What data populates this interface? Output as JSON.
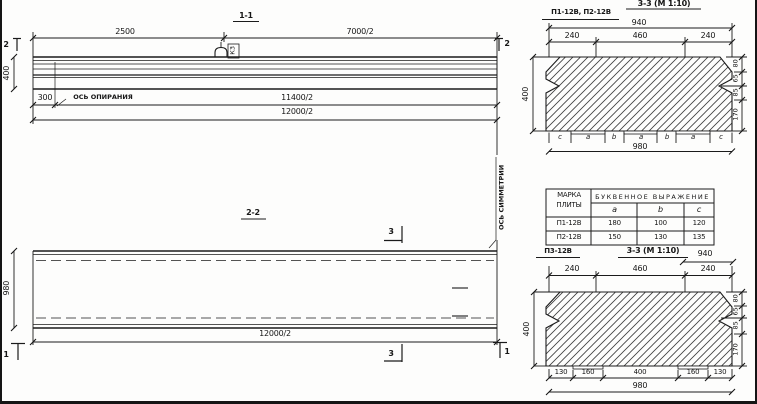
{
  "s11": {
    "title": "1-1",
    "marker2": "2",
    "dim2500": "2500",
    "dim7000": "7000/2",
    "dim400": "400",
    "dim300": "300",
    "support_axis": "ОСЬ ОПИРАНИЯ",
    "hook_mark": "К3",
    "dim11400": "11400/2",
    "dim12000": "12000/2"
  },
  "s22": {
    "title": "2-2",
    "marker3": "3",
    "marker1": "1",
    "dim980": "980",
    "dim12000": "12000/2",
    "symmetry_axis": "ОСЬ СИММЕТРИИ"
  },
  "s33t": {
    "plates": "П1-12В, П2-12В",
    "title": "3-3 (М 1:10)",
    "dim940": "940",
    "dim240l": "240",
    "dim460": "460",
    "dim240r": "240",
    "dim400": "400",
    "dim80": "80",
    "dim65": "65",
    "dim85": "85",
    "dim170": "170",
    "dim980": "980",
    "letters": [
      "c",
      "a",
      "b",
      "a",
      "b",
      "a",
      "c"
    ]
  },
  "table": {
    "hdr_mark1": "МАРКА",
    "hdr_mark2": "ПЛИТЫ",
    "hdr_expr": "БУКВЕННОЕ ВЫРАЖЕНИЕ",
    "col_a": "a",
    "col_b": "b",
    "col_c": "c",
    "rows": [
      {
        "mark": "П1-12В",
        "a": "180",
        "b": "100",
        "c": "120"
      },
      {
        "mark": "П2-12В",
        "a": "150",
        "b": "130",
        "c": "135"
      }
    ]
  },
  "s33b": {
    "plate": "П3-12В",
    "title": "3-3 (М 1:10)",
    "dim940": "940",
    "dim240l": "240",
    "dim460": "460",
    "dim240r": "240",
    "dim400": "400",
    "dim80": "80",
    "dim65": "65",
    "dim85": "85",
    "dim170": "170",
    "dim130l": "130",
    "dim160l": "160",
    "dim400b": "400",
    "dim160r": "160",
    "dim130r": "130",
    "dim980": "980"
  }
}
